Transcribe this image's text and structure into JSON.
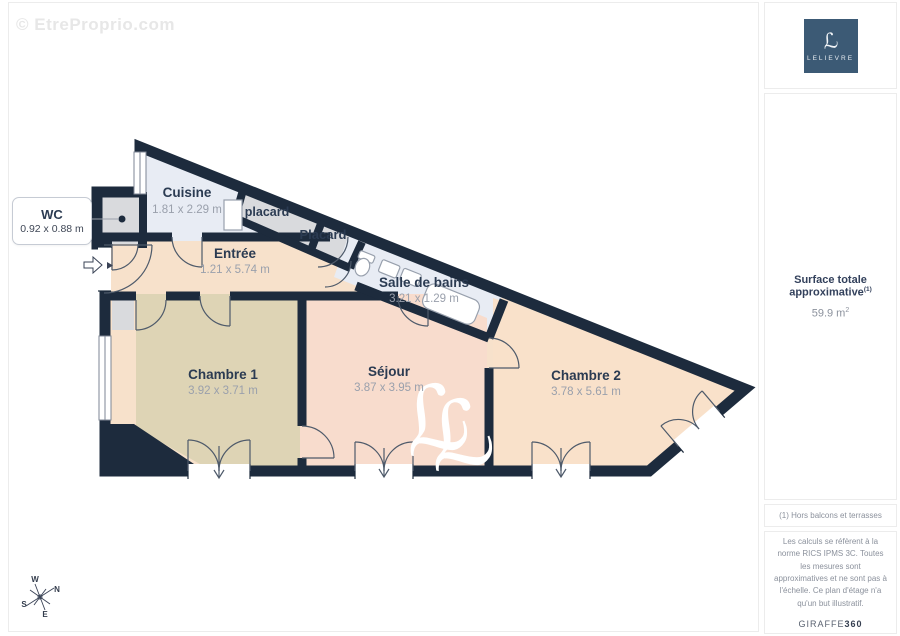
{
  "watermark": "© EtreProprio.com",
  "brand": {
    "monogram": "ℒ",
    "name": "LELIEVRE"
  },
  "plan": {
    "wc_callout": {
      "name": "WC",
      "dims": "0.92 x 0.88 m"
    },
    "rooms": {
      "cuisine": {
        "name": "Cuisine",
        "dims": "1.81 x 2.29 m"
      },
      "placard_small": {
        "name": "placard"
      },
      "placard": {
        "name": "Placard"
      },
      "salle_de_bains": {
        "name": "Salle de bains",
        "dims": "3.21 x 1.29 m"
      },
      "entree": {
        "name": "Entrée",
        "dims": "1.21 x 5.74 m"
      },
      "chambre1": {
        "name": "Chambre 1",
        "dims": "3.92 x 3.71 m"
      },
      "sejour": {
        "name": "Séjour",
        "dims": "3.87 x 3.95 m"
      },
      "chambre2": {
        "name": "Chambre 2",
        "dims": "3.78 x 5.61 m"
      }
    },
    "compass": {
      "n": "N",
      "e": "E",
      "s": "S",
      "w": "W"
    }
  },
  "sidebar": {
    "surface_label": "Surface totale approximative",
    "surface_sup": "(1)",
    "surface_value": "59.9 m",
    "surface_value_sup": "2",
    "footnote": "(1) Hors balcons et terrasses",
    "legal": "Les calculs se réfèrent à la norme RICS IPMS 3C. Toutes les mesures sont approximatives et ne sont pas à l'échelle. Ce plan d'étage n'a qu'un but illustratif.",
    "brand_text": "GIRAFFE",
    "brand_number": "360"
  },
  "colors": {
    "wall": "#1d2b3d",
    "cuisine_floor": "#e8ecf4",
    "closet_floor": "#d9dadd",
    "entree_floor": "#f7e1cb",
    "chambre1_floor": "#ded4b5",
    "sejour_floor": "#f8dccd",
    "chambre2_floor": "#f9e1ca",
    "brand_navy": "#3c5a75",
    "label_text": "#2b3b52",
    "dims_text": "#9aa0ac"
  }
}
